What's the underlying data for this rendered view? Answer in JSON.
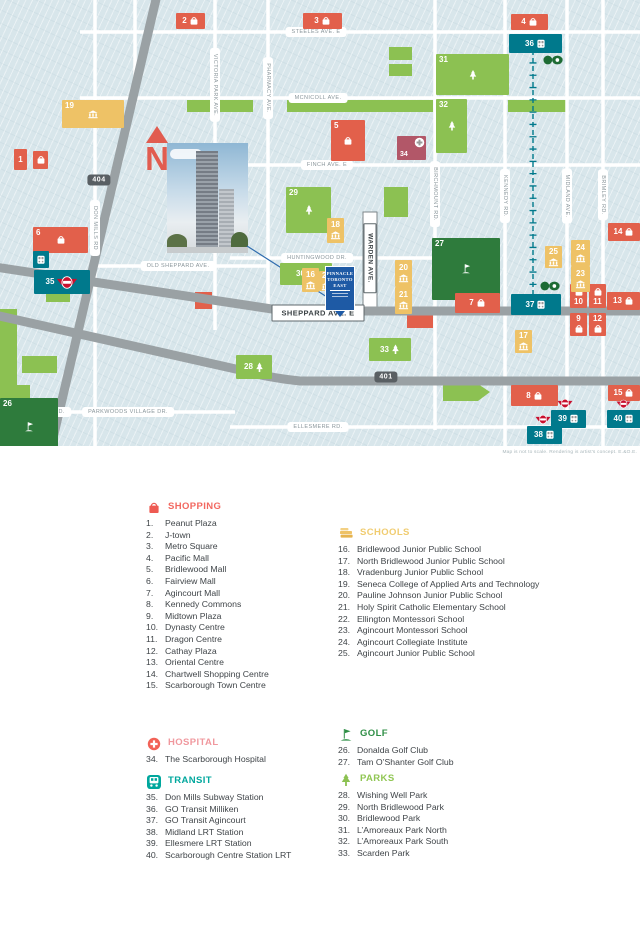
{
  "colors": {
    "shopping": "#e2604b",
    "schools": "#eec266",
    "transit": "#00798c",
    "parks": "#8cc152",
    "golf": "#2e7b3c",
    "hospital": "#b25768",
    "pinnacle_blue": "#1e5aa5",
    "map_bg": "#d8e6eb",
    "road_gray": "#9aa1a4",
    "north_arrow": "#e15c50",
    "ttc_red": "#c8102e",
    "go_green": "#1d6b34"
  },
  "map": {
    "north": "N",
    "disclaimer": "Map is not to scale.   Rendering is artist's concept.   E.&O.E.",
    "property_sign": {
      "lines": [
        "PINNACLE",
        "TORONTO",
        "EAST"
      ]
    },
    "highway_shields": [
      {
        "label": "404",
        "x": 99,
        "y": 180
      },
      {
        "label": "401",
        "x": 386,
        "y": 377
      }
    ],
    "street_labels": [
      {
        "text": "STEELES AVE. E",
        "x": 316,
        "y": 32
      },
      {
        "text": "MCNICOLL AVE.",
        "x": 318,
        "y": 98
      },
      {
        "text": "FINCH AVE. E",
        "x": 327,
        "y": 165
      },
      {
        "text": "HUNTINGWOOD DR.",
        "x": 317,
        "y": 258
      },
      {
        "text": "OLD SHEPPARD AVE.",
        "x": 178,
        "y": 266
      },
      {
        "text": "SHEPPARD AVE. E",
        "x": 318,
        "y": 313,
        "boxed": true
      },
      {
        "text": "YORK MILLS RD.",
        "x": 40,
        "y": 412
      },
      {
        "text": "PARKWOODS VILLAGE DR.",
        "x": 128,
        "y": 412
      },
      {
        "text": "ELLESMERE RD.",
        "x": 318,
        "y": 427
      },
      {
        "text": "DON MILLS RD",
        "x": 95,
        "y": 228,
        "vertical": true
      },
      {
        "text": "VICTORIA PARK AVE.",
        "x": 215,
        "y": 85,
        "vertical": true
      },
      {
        "text": "PHARMACY AVE.",
        "x": 268,
        "y": 88,
        "vertical": true
      },
      {
        "text": "WARDEN AVE.",
        "x": 370,
        "y": 258,
        "vertical": true,
        "boxed": true
      },
      {
        "text": "BIRCHMOUNT RD.",
        "x": 435,
        "y": 194,
        "vertical": true
      },
      {
        "text": "KENNEDY RD.",
        "x": 505,
        "y": 196,
        "vertical": true
      },
      {
        "text": "MIDLAND AVE.",
        "x": 567,
        "y": 196,
        "vertical": true
      },
      {
        "text": "BRIMLEY RD.",
        "x": 603,
        "y": 195,
        "vertical": true
      }
    ],
    "markers": [
      {
        "n": "19",
        "cat": "schools",
        "icon": "school",
        "x": 62,
        "y": 100,
        "w": 62,
        "h": 28,
        "lay": "area"
      },
      {
        "n": "5",
        "cat": "shopping",
        "icon": "bag",
        "x": 331,
        "y": 120,
        "w": 34,
        "h": 41,
        "lay": "area"
      },
      {
        "n": "6",
        "cat": "shopping",
        "icon": "bag",
        "x": 33,
        "y": 227,
        "w": 55,
        "h": 26,
        "lay": "area"
      },
      {
        "n": "26",
        "cat": "golf",
        "icon": "flag",
        "x": 0,
        "y": 398,
        "w": 58,
        "h": 57,
        "lay": "area"
      },
      {
        "n": "27",
        "cat": "golf",
        "icon": "flag",
        "x": 432,
        "y": 238,
        "w": 68,
        "h": 62,
        "lay": "area"
      },
      {
        "n": "29",
        "cat": "parks",
        "icon": "tree",
        "x": 286,
        "y": 187,
        "w": 45,
        "h": 46,
        "lay": "area"
      },
      {
        "n": "31",
        "cat": "parks",
        "icon": "tree",
        "x": 436,
        "y": 54,
        "w": 73,
        "h": 41,
        "lay": "area"
      },
      {
        "n": "32",
        "cat": "parks",
        "icon": "tree",
        "x": 436,
        "y": 99,
        "w": 31,
        "h": 54,
        "lay": "area"
      },
      {
        "n": "30",
        "cat": "parks",
        "icon": "tree",
        "x": 280,
        "y": 263,
        "w": 52,
        "h": 22,
        "lay": "row"
      },
      {
        "n": "28",
        "cat": "parks",
        "icon": "tree",
        "x": 236,
        "y": 355,
        "w": 36,
        "h": 24,
        "lay": "row"
      },
      {
        "n": "33",
        "cat": "parks",
        "icon": "tree",
        "x": 369,
        "y": 338,
        "w": 42,
        "h": 23,
        "lay": "row"
      },
      {
        "n": "1",
        "cat": "shopping",
        "x": 14,
        "y": 149,
        "w": 13,
        "h": 21,
        "lay": "num"
      },
      {
        "cat": "shopping",
        "icon": "bag",
        "x": 33,
        "y": 151,
        "w": 15,
        "h": 18,
        "lay": "icon"
      },
      {
        "n": "2",
        "cat": "shopping",
        "icon": "bag",
        "x": 176,
        "y": 13,
        "w": 29,
        "h": 16,
        "lay": "row"
      },
      {
        "n": "3",
        "cat": "shopping",
        "icon": "bag",
        "x": 303,
        "y": 13,
        "w": 39,
        "h": 16,
        "lay": "row"
      },
      {
        "n": "4",
        "cat": "shopping",
        "icon": "bag",
        "x": 511,
        "y": 14,
        "w": 37,
        "h": 16,
        "lay": "row"
      },
      {
        "n": "7",
        "cat": "shopping",
        "icon": "bag",
        "x": 455,
        "y": 293,
        "w": 45,
        "h": 20,
        "lay": "row"
      },
      {
        "n": "8",
        "cat": "shopping",
        "icon": "bag",
        "x": 511,
        "y": 385,
        "w": 47,
        "h": 21,
        "lay": "row"
      },
      {
        "n": "9",
        "cat": "shopping",
        "icon": "bag",
        "x": 570,
        "y": 313,
        "w": 17,
        "h": 23,
        "lay": "col"
      },
      {
        "n": "12",
        "cat": "shopping",
        "icon": "bag",
        "x": 589,
        "y": 313,
        "w": 17,
        "h": 23,
        "lay": "col"
      },
      {
        "n": "10",
        "cat": "shopping",
        "icon": "bag",
        "x": 570,
        "y": 284,
        "w": 17,
        "h": 24,
        "lay": "col-rev"
      },
      {
        "n": "11",
        "cat": "shopping",
        "icon": "bag",
        "x": 589,
        "y": 284,
        "w": 17,
        "h": 24,
        "lay": "col-rev"
      },
      {
        "n": "13",
        "cat": "shopping",
        "icon": "bag",
        "x": 607,
        "y": 292,
        "w": 33,
        "h": 18,
        "lay": "row"
      },
      {
        "n": "14",
        "cat": "shopping",
        "icon": "bag",
        "x": 608,
        "y": 223,
        "w": 32,
        "h": 18,
        "lay": "row"
      },
      {
        "n": "15",
        "cat": "shopping",
        "icon": "bag",
        "x": 608,
        "y": 385,
        "w": 32,
        "h": 16,
        "lay": "row"
      },
      {
        "n": "16",
        "cat": "schools",
        "icon": "school",
        "x": 302,
        "y": 268,
        "w": 17,
        "h": 24,
        "lay": "col"
      },
      {
        "n": "22",
        "cat": "schools",
        "icon": "school",
        "x": 319,
        "y": 271,
        "w": 15,
        "h": 20,
        "lay": "col"
      },
      {
        "n": "17",
        "cat": "schools",
        "icon": "school",
        "x": 515,
        "y": 330,
        "w": 17,
        "h": 23,
        "lay": "col"
      },
      {
        "n": "18",
        "cat": "schools",
        "icon": "school",
        "x": 327,
        "y": 218,
        "w": 17,
        "h": 25,
        "lay": "col"
      },
      {
        "n": "20",
        "cat": "schools",
        "icon": "school",
        "x": 395,
        "y": 260,
        "w": 17,
        "h": 27,
        "lay": "col"
      },
      {
        "n": "21",
        "cat": "schools",
        "icon": "school",
        "x": 395,
        "y": 287,
        "w": 17,
        "h": 27,
        "lay": "col"
      },
      {
        "n": "23",
        "cat": "schools",
        "icon": "school",
        "x": 571,
        "y": 266,
        "w": 19,
        "h": 26,
        "lay": "col"
      },
      {
        "n": "24",
        "cat": "schools",
        "icon": "school",
        "x": 571,
        "y": 240,
        "w": 19,
        "h": 26,
        "lay": "col"
      },
      {
        "n": "25",
        "cat": "schools",
        "icon": "school",
        "x": 545,
        "y": 246,
        "w": 17,
        "h": 22,
        "lay": "col"
      },
      {
        "cat": "transit",
        "icon": "train",
        "x": 33,
        "y": 251,
        "w": 16,
        "h": 17,
        "lay": "icon"
      },
      {
        "n": "35",
        "cat": "transit",
        "icon": "ttc",
        "x": 34,
        "y": 270,
        "w": 56,
        "h": 24,
        "lay": "row"
      },
      {
        "n": "36",
        "cat": "transit",
        "icon": "train",
        "x": 509,
        "y": 34,
        "w": 53,
        "h": 19,
        "lay": "row"
      },
      {
        "cat": "transit",
        "icon": "go",
        "x": 543,
        "y": 55,
        "w": 20,
        "h": 10,
        "lay": "icon",
        "bare": true
      },
      {
        "n": "37",
        "cat": "transit",
        "icon": "train",
        "x": 511,
        "y": 294,
        "w": 50,
        "h": 21,
        "lay": "row"
      },
      {
        "cat": "transit",
        "icon": "go",
        "x": 540,
        "y": 281,
        "w": 20,
        "h": 10,
        "lay": "icon",
        "bare": true
      },
      {
        "cat": "transit",
        "icon": "ttc",
        "x": 535,
        "y": 414,
        "w": 16,
        "h": 11,
        "lay": "icon",
        "bare": true
      },
      {
        "n": "38",
        "cat": "transit",
        "icon": "train",
        "x": 527,
        "y": 426,
        "w": 35,
        "h": 18,
        "lay": "row"
      },
      {
        "cat": "transit",
        "icon": "ttc",
        "x": 557,
        "y": 398,
        "w": 16,
        "h": 11,
        "lay": "icon",
        "bare": true
      },
      {
        "n": "39",
        "cat": "transit",
        "icon": "train",
        "x": 551,
        "y": 410,
        "w": 35,
        "h": 18,
        "lay": "row"
      },
      {
        "cat": "transit",
        "icon": "ttc",
        "x": 616,
        "y": 399,
        "w": 15,
        "h": 10,
        "lay": "icon",
        "bare": true
      },
      {
        "n": "40",
        "cat": "transit",
        "icon": "train",
        "x": 607,
        "y": 410,
        "w": 34,
        "h": 18,
        "lay": "row"
      },
      {
        "n": "34",
        "cat": "hospital",
        "icon": "cross",
        "x": 397,
        "y": 136,
        "w": 29,
        "h": 24,
        "lay": "hosp"
      }
    ]
  },
  "legend": {
    "sections": [
      {
        "id": "shopping",
        "title": "SHOPPING",
        "items": [
          {
            "n": "1.",
            "label": "Peanut Plaza"
          },
          {
            "n": "2.",
            "label": "J-town"
          },
          {
            "n": "3.",
            "label": "Metro Square"
          },
          {
            "n": "4.",
            "label": "Pacific Mall"
          },
          {
            "n": "5.",
            "label": "Bridlewood Mall"
          },
          {
            "n": "6.",
            "label": "Fairview Mall"
          },
          {
            "n": "7.",
            "label": "Agincourt Mall"
          },
          {
            "n": "8.",
            "label": "Kennedy Commons"
          },
          {
            "n": "9.",
            "label": "Midtown Plaza"
          },
          {
            "n": "10.",
            "label": "Dynasty Centre"
          },
          {
            "n": "11.",
            "label": "Dragon Centre"
          },
          {
            "n": "12.",
            "label": "Cathay Plaza"
          },
          {
            "n": "13.",
            "label": "Oriental Centre"
          },
          {
            "n": "14.",
            "label": "Chartwell Shopping Centre"
          },
          {
            "n": "15.",
            "label": "Scarborough Town Centre"
          }
        ]
      },
      {
        "id": "schools",
        "title": "SCHOOLS",
        "items": [
          {
            "n": "16.",
            "label": "Bridlewood Junior Public School"
          },
          {
            "n": "17.",
            "label": "North Bridlewood Junior Public School"
          },
          {
            "n": "18.",
            "label": "Vradenburg Junior Public School"
          },
          {
            "n": "19.",
            "label": "Seneca College of Applied Arts and Technology"
          },
          {
            "n": "20.",
            "label": "Pauline Johnson Junior Public School"
          },
          {
            "n": "21.",
            "label": "Holy Spirit Catholic Elementary School"
          },
          {
            "n": "22.",
            "label": "Ellington Montessori School"
          },
          {
            "n": "23.",
            "label": "Agincourt Montessori School"
          },
          {
            "n": "24.",
            "label": "Agincourt Collegiate Institute"
          },
          {
            "n": "25.",
            "label": "Agincourt Junior Public School"
          }
        ]
      },
      {
        "id": "hospital",
        "title": "HOSPITAL",
        "items": [
          {
            "n": "34.",
            "label": "The Scarborough Hospital"
          }
        ]
      },
      {
        "id": "transit",
        "title": "TRANSIT",
        "items": [
          {
            "n": "35.",
            "label": "Don Mills Subway Station"
          },
          {
            "n": "36.",
            "label": "GO Transit Milliken"
          },
          {
            "n": "37.",
            "label": "GO Transit Agincourt"
          },
          {
            "n": "38.",
            "label": "Midland LRT Station"
          },
          {
            "n": "39.",
            "label": "Ellesmere LRT Station"
          },
          {
            "n": "40.",
            "label": "Scarborough Centre Station LRT"
          }
        ]
      },
      {
        "id": "golf",
        "title": "GOLF",
        "items": [
          {
            "n": "26.",
            "label": "Donalda Golf Club"
          },
          {
            "n": "27.",
            "label": "Tam O’Shanter Golf Club"
          }
        ]
      },
      {
        "id": "parks",
        "title": "PARKS",
        "items": [
          {
            "n": "28.",
            "label": "Wishing Well Park"
          },
          {
            "n": "29.",
            "label": "North Bridlewood Park"
          },
          {
            "n": "30.",
            "label": "Bridlewood Park"
          },
          {
            "n": "31.",
            "label": "L’Amoreaux Park North"
          },
          {
            "n": "32.",
            "label": "L’Amoreaux Park South"
          },
          {
            "n": "33.",
            "label": "Scarden Park"
          }
        ]
      }
    ]
  }
}
